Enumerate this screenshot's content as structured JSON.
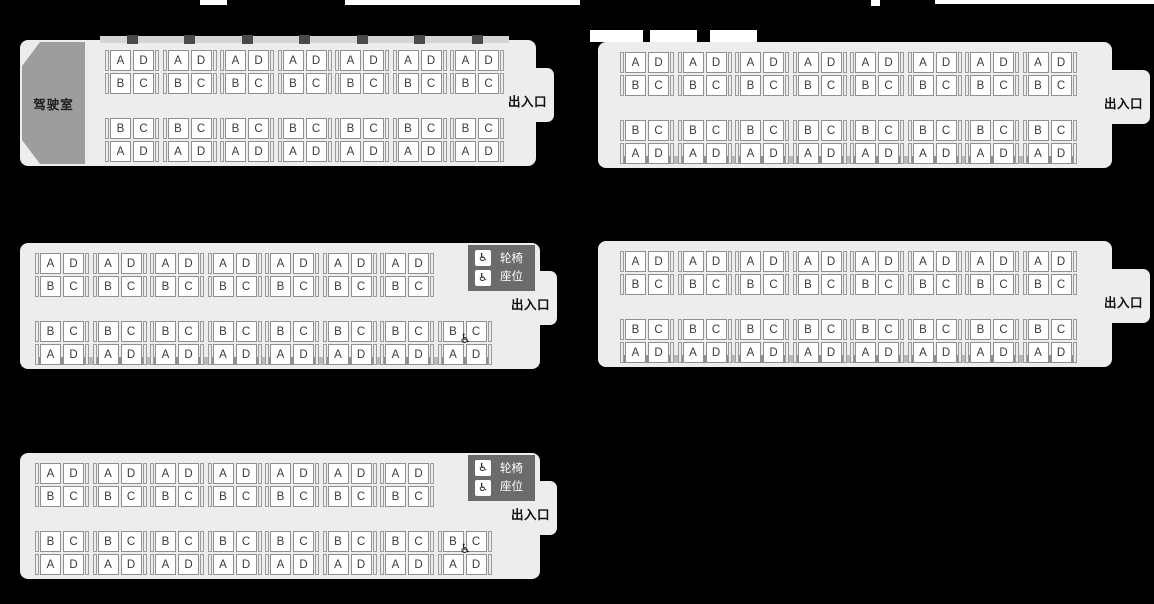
{
  "diagram": {
    "type": "train-seat-map",
    "background": "#000000",
    "labels": {
      "driver_cab": "驾驶室",
      "exit": "出入口",
      "wheelchair_line1": "轮椅",
      "wheelchair_line2": "座位"
    },
    "wheelchair_icon": "♿",
    "seat_rows": {
      "top_bank": [
        [
          "A",
          "D"
        ],
        [
          "B",
          "C"
        ]
      ],
      "bottom_bank": [
        [
          "B",
          "C"
        ],
        [
          "A",
          "D"
        ]
      ]
    },
    "colors": {
      "car_body": "#ededed",
      "driver_cab": "#9d9d9d",
      "wheelchair_zone": "#6b6b6b",
      "seat_fill": "#ffffff",
      "seat_border": "#8f8f8f",
      "seat_letter": "#3a3a3a",
      "exit_text": "#101010"
    },
    "cars": [
      {
        "name": "car-1",
        "driver_cab": true,
        "wheelchair_zone": false,
        "wheelchair_seat": false,
        "top_columns": 7,
        "bottom_columns": 7,
        "exit_label": "出入口",
        "driver_cab_label": "驾驶室"
      },
      {
        "name": "car-2",
        "driver_cab": false,
        "wheelchair_zone": false,
        "wheelchair_seat": false,
        "top_columns": 8,
        "bottom_columns": 8,
        "exit_label": "出入口"
      },
      {
        "name": "car-3",
        "driver_cab": false,
        "wheelchair_zone": true,
        "wheelchair_seat": true,
        "top_columns": 7,
        "bottom_columns": 8,
        "exit_label": "出入口",
        "wheelchair_labels": [
          "轮椅",
          "座位"
        ]
      },
      {
        "name": "car-4",
        "driver_cab": false,
        "wheelchair_zone": false,
        "wheelchair_seat": false,
        "top_columns": 8,
        "bottom_columns": 8,
        "exit_label": "出入口"
      },
      {
        "name": "car-5",
        "driver_cab": false,
        "wheelchair_zone": true,
        "wheelchair_seat": true,
        "top_columns": 7,
        "bottom_columns": 8,
        "exit_label": "出入口",
        "wheelchair_labels": [
          "轮椅",
          "座位"
        ]
      }
    ]
  }
}
